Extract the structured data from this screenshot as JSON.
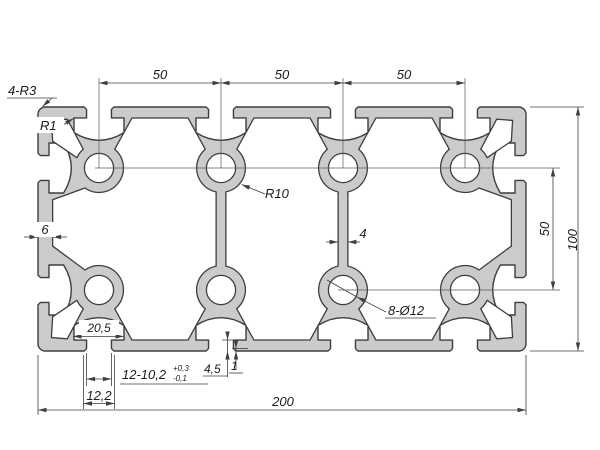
{
  "drawing": {
    "type": "technical-cross-section",
    "part": "aluminium-extrusion-profile-200x100",
    "labels": {
      "corner_radius_callout": "4-R3",
      "fillet_callout": "R1",
      "cavity_radius_callout": "R10",
      "bore_callout": "8-Ø12",
      "slot_pitch_1": "50",
      "slot_pitch_2": "50",
      "slot_pitch_3": "50",
      "overall_height": "100",
      "row_pitch": "50",
      "overall_width": "200",
      "side_wall_thickness": "6",
      "web_thickness": "4",
      "slot_channel_width": "20,5",
      "slot_opening_callout": "12-10,2",
      "slot_opening_tol_upper": "+0,3",
      "slot_opening_tol_lower": "-0,1",
      "slot_outer_opening_width": "12,2",
      "slot_lip_depth": "4,5",
      "slot_lip_chamfer": "1"
    },
    "colors": {
      "profile_fill": "#cbcbcb",
      "outline": "#3e3e3e",
      "dimension_lines": "#3f3f3f",
      "centerline": "#5a5a5a",
      "text": "#1c1c1c",
      "background": "#ffffff"
    }
  }
}
